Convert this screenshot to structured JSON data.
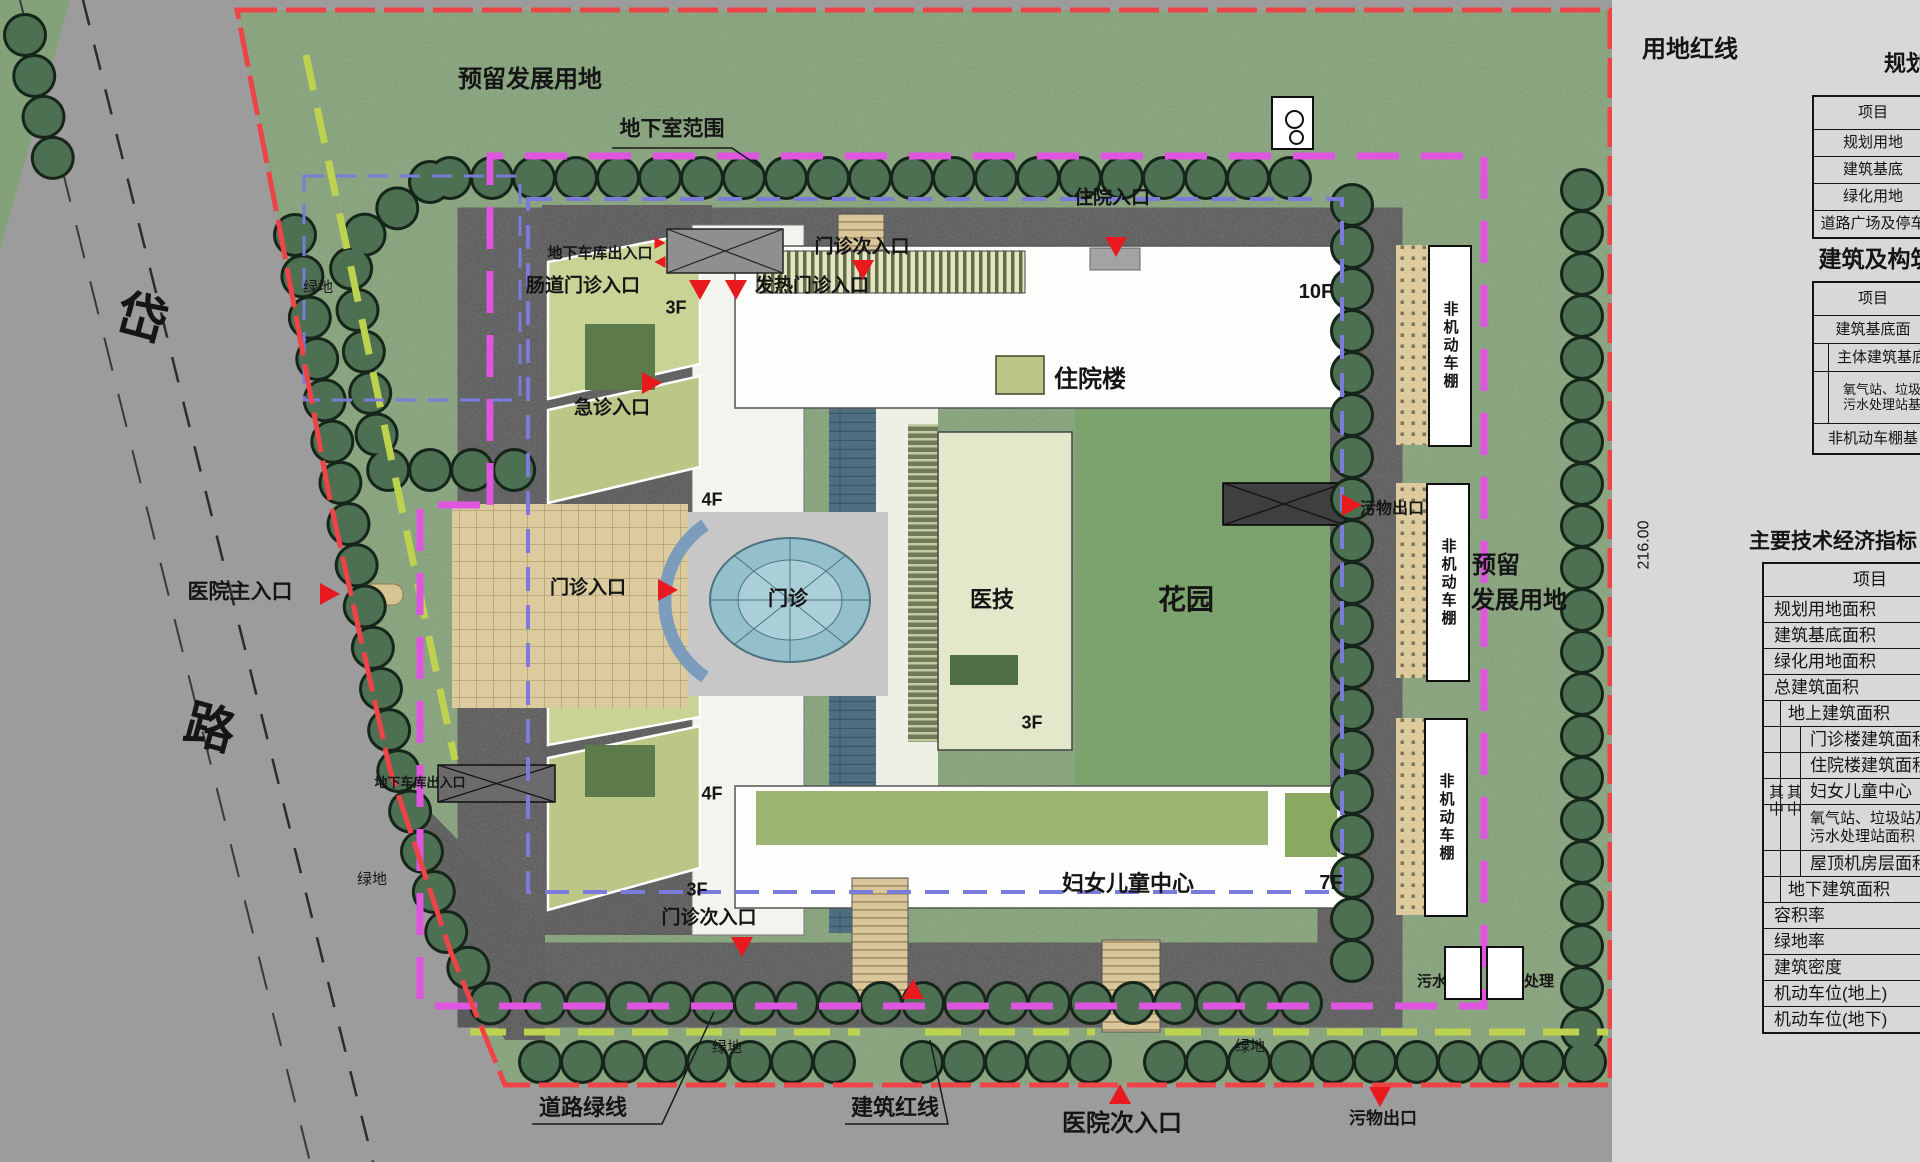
{
  "colors": {
    "site_boundary_red": "#ee4448",
    "basement_line_magenta": "#e055e0",
    "road_green_line": "#bdd34f",
    "building_blue_line": "#7b7bdc",
    "entrance_marker_red": "#e81a20"
  },
  "plan": {
    "labels": [
      {
        "n": "reserved-land-top",
        "t": "预留发展用地",
        "x": 530,
        "y": 80,
        "s": 24
      },
      {
        "n": "basement-range",
        "t": "地下室范围",
        "x": 672,
        "y": 130,
        "s": 21
      },
      {
        "n": "land-red-line",
        "t": "用地红线",
        "x": 1690,
        "y": 50,
        "s": 24
      },
      {
        "n": "dim-216",
        "t": "216.00",
        "x": 1644,
        "y": 545,
        "s": 16,
        "r": -90,
        "thin": 1
      },
      {
        "n": "road-char-1",
        "t": "岱",
        "x": 142,
        "y": 318,
        "s": 50,
        "r": 15
      },
      {
        "n": "road-char-2",
        "t": "路",
        "x": 210,
        "y": 728,
        "s": 50,
        "r": 15
      },
      {
        "n": "green-area-1",
        "t": "绿地",
        "x": 318,
        "y": 288,
        "s": 15,
        "thin": 1
      },
      {
        "n": "green-area-2",
        "t": "绿地",
        "x": 372,
        "y": 880,
        "s": 15,
        "thin": 1
      },
      {
        "n": "green-area-3",
        "t": "绿地",
        "x": 727,
        "y": 1048,
        "s": 15,
        "thin": 1
      },
      {
        "n": "green-area-4",
        "t": "绿地",
        "x": 1250,
        "y": 1047,
        "s": 15,
        "thin": 1
      },
      {
        "n": "hospital-main-entrance",
        "t": "医院主入口",
        "x": 240,
        "y": 593,
        "s": 21
      },
      {
        "n": "outpatient-entrance",
        "t": "门诊入口",
        "x": 588,
        "y": 589,
        "s": 19
      },
      {
        "n": "outpatient-plaza",
        "t": "门诊",
        "x": 788,
        "y": 600,
        "s": 20
      },
      {
        "n": "emergency-entrance",
        "t": "急诊入口",
        "x": 612,
        "y": 409,
        "s": 19
      },
      {
        "n": "bowel-clinic-entrance",
        "t": "肠道门诊入口",
        "x": 583,
        "y": 287,
        "s": 19
      },
      {
        "n": "fever-clinic-entrance",
        "t": "发热门诊入口",
        "x": 812,
        "y": 287,
        "s": 19
      },
      {
        "n": "outpatient-sub-entrance-top",
        "t": "门诊次入口",
        "x": 862,
        "y": 248,
        "s": 19
      },
      {
        "n": "garage-exit-top",
        "t": "地下车库出入口",
        "x": 600,
        "y": 254,
        "s": 15
      },
      {
        "n": "garage-exit-bottom",
        "t": "地下车库出入口",
        "x": 420,
        "y": 783,
        "s": 13
      },
      {
        "n": "inpatient-entrance",
        "t": "住院入口",
        "x": 1112,
        "y": 199,
        "s": 19
      },
      {
        "n": "inpatient-building",
        "t": "住院楼",
        "x": 1090,
        "y": 380,
        "s": 24
      },
      {
        "n": "floor-10f",
        "t": "10F",
        "x": 1316,
        "y": 293,
        "s": 20
      },
      {
        "n": "medical-tech-building",
        "t": "医技",
        "x": 992,
        "y": 600,
        "s": 22
      },
      {
        "n": "floor-3f-medtech",
        "t": "3F",
        "x": 1032,
        "y": 723,
        "s": 18
      },
      {
        "n": "floor-3f-north",
        "t": "3F",
        "x": 676,
        "y": 308,
        "s": 18
      },
      {
        "n": "floor-4f-a",
        "t": "4F",
        "x": 712,
        "y": 500,
        "s": 18
      },
      {
        "n": "floor-4f-b",
        "t": "4F",
        "x": 712,
        "y": 794,
        "s": 18
      },
      {
        "n": "floor-3f-south",
        "t": "3F",
        "x": 697,
        "y": 890,
        "s": 18
      },
      {
        "n": "garden",
        "t": "花园",
        "x": 1186,
        "y": 600,
        "s": 28
      },
      {
        "n": "women-children-center",
        "t": "妇女儿童中心",
        "x": 1128,
        "y": 884,
        "s": 22
      },
      {
        "n": "floor-7f",
        "t": "7F",
        "x": 1331,
        "y": 884,
        "s": 20
      },
      {
        "n": "outpatient-sub-entrance-bottom",
        "t": "门诊次入口",
        "x": 709,
        "y": 919,
        "s": 19
      },
      {
        "n": "hospital-sub-entrance",
        "t": "医院次入口",
        "x": 1122,
        "y": 1124,
        "s": 24
      },
      {
        "n": "waste-exit-mid",
        "t": "污物出口",
        "x": 1392,
        "y": 509,
        "s": 16
      },
      {
        "n": "waste-exit-bottom",
        "t": "污物出口",
        "x": 1383,
        "y": 1119,
        "s": 17
      },
      {
        "n": "road-green-line",
        "t": "道路绿线",
        "x": 583,
        "y": 1108,
        "s": 22
      },
      {
        "n": "building-red-line",
        "t": "建筑红线",
        "x": 895,
        "y": 1108,
        "s": 22
      },
      {
        "n": "reserved-land-right-1",
        "t": "预留",
        "x": 1496,
        "y": 566,
        "s": 24
      },
      {
        "n": "reserved-land-right-2",
        "t": "发展用地",
        "x": 1519,
        "y": 601,
        "s": 24
      },
      {
        "n": "oxygen-station",
        "t": "氧气站",
        "x": 1292,
        "y": 137,
        "s": 14
      },
      {
        "n": "floor-1f-oxygen",
        "t": "1F",
        "x": 1303,
        "y": 104,
        "s": 13
      },
      {
        "n": "sewage-treatment",
        "t": "污水处理",
        "x": 1447,
        "y": 982,
        "s": 15
      },
      {
        "n": "floor-1f-sewage",
        "t": "1F",
        "x": 1464,
        "y": 956,
        "s": 13
      },
      {
        "n": "waste-treatment",
        "t": "污物处理",
        "x": 1524,
        "y": 982,
        "s": 15
      },
      {
        "n": "floor-1f-waste",
        "t": "1F",
        "x": 1506,
        "y": 956,
        "s": 13
      }
    ],
    "triangles": [
      {
        "n": "main-entrance-arrow",
        "d": "right",
        "x": 330,
        "y": 594
      },
      {
        "n": "outpatient-entrance-arrow",
        "d": "right",
        "x": 668,
        "y": 590
      },
      {
        "n": "emergency-entrance-arrow",
        "d": "right",
        "x": 652,
        "y": 383
      },
      {
        "n": "waste-exit-mid-arrow",
        "d": "right",
        "x": 1352,
        "y": 505
      },
      {
        "n": "bowel-entrance-arrow",
        "d": "down",
        "x": 700,
        "y": 290
      },
      {
        "n": "fever-entrance-arrow",
        "d": "down",
        "x": 736,
        "y": 290
      },
      {
        "n": "outpatient-sub-top-arrow",
        "d": "down",
        "x": 863,
        "y": 270
      },
      {
        "n": "inpatient-entrance-arrow",
        "d": "down",
        "x": 1116,
        "y": 247
      },
      {
        "n": "waste-exit-bottom-arrow",
        "d": "down",
        "x": 1380,
        "y": 1097
      },
      {
        "n": "outpatient-sub-bottom-arrow",
        "d": "down",
        "x": 742,
        "y": 947
      },
      {
        "n": "hospital-sub-entrance-arrow",
        "d": "up",
        "x": 1120,
        "y": 1094
      },
      {
        "n": "south-path-arrow",
        "d": "up",
        "x": 913,
        "y": 989
      },
      {
        "n": "garage-arrow-a",
        "d": "right",
        "x": 660,
        "y": 243,
        "sm": 1
      },
      {
        "n": "garage-arrow-b",
        "d": "left",
        "x": 660,
        "y": 262,
        "sm": 1
      }
    ],
    "sheds": {
      "label": "非机动车棚",
      "items": [
        {
          "x": 1428,
          "y": 245,
          "w": 40,
          "h": 198
        },
        {
          "x": 1426,
          "y": 483,
          "w": 40,
          "h": 195
        },
        {
          "x": 1424,
          "y": 718,
          "w": 40,
          "h": 195
        }
      ]
    },
    "boxes": [
      {
        "n": "oxygen-station-box",
        "x": 1271,
        "y": 96,
        "w": 43,
        "h": 54,
        "circles": 1
      },
      {
        "n": "sewage-treatment-box",
        "x": 1444,
        "y": 946,
        "w": 38,
        "h": 54
      },
      {
        "n": "waste-treatment-box",
        "x": 1486,
        "y": 946,
        "w": 38,
        "h": 54
      }
    ]
  },
  "panel": {
    "tables": {
      "planning": {
        "title": "规划",
        "header": "项目",
        "rows": [
          "规划用地",
          "建筑基底",
          "绿化用地",
          "道路广场及停车"
        ]
      },
      "construction": {
        "title": "建筑及构筑",
        "header": "项目",
        "rows": [
          {
            "t": "建筑基底面"
          },
          {
            "t": "主体建筑基底",
            "lv": 1
          },
          {
            "t": "氧气站、垃圾\n污水处理站基",
            "lv": 1,
            "two": 1
          },
          {
            "t": "非机动车棚基"
          }
        ]
      },
      "indicators": {
        "title": "主要技术经济指标",
        "header": "项目",
        "subgroup_label": "其中",
        "rows": [
          {
            "t": "规划用地面积"
          },
          {
            "t": "建筑基底面积"
          },
          {
            "t": "绿化用地面积"
          },
          {
            "t": "总建筑面积"
          },
          {
            "t": "地上建筑面积",
            "lv": 1
          },
          {
            "t": "门诊楼建筑面积",
            "lv": 2
          },
          {
            "t": "住院楼建筑面积",
            "lv": 2
          },
          {
            "t": "妇女儿童中心",
            "lv": 2
          },
          {
            "t": "氧气站、垃圾站及\n污水处理站面积",
            "lv": 2,
            "two": 1
          },
          {
            "t": "屋顶机房层面积",
            "lv": 2
          },
          {
            "t": "地下建筑面积",
            "lv": 1
          },
          {
            "t": "容积率"
          },
          {
            "t": "绿地率"
          },
          {
            "t": "建筑密度"
          },
          {
            "t": "机动车位(地上)"
          },
          {
            "t": "机动车位(地下)"
          }
        ]
      }
    }
  }
}
